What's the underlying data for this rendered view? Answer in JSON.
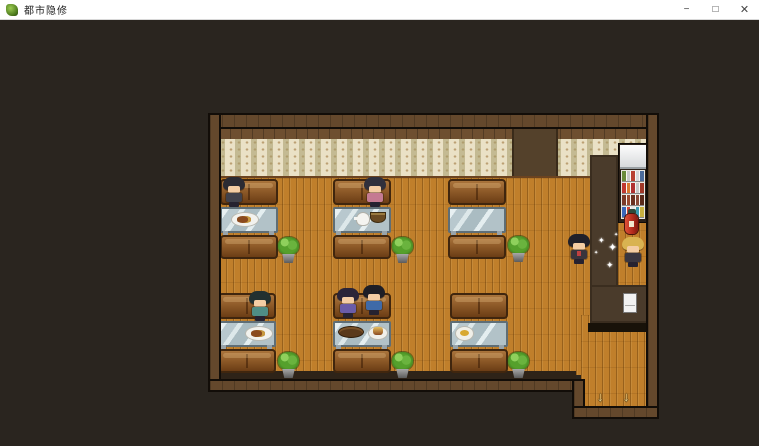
{
  "window": {
    "title": "都市隐修",
    "controls": {
      "minimize": "−",
      "maximize": "□",
      "close": "✕"
    }
  },
  "colors": {
    "titlebar": "#ffffff",
    "viewport_bg": "#2a251f",
    "frame_wood": "#64482c",
    "wallpaper": "#eae1c6",
    "floor_wood": "#c07f2b",
    "couch": "#8f5b29",
    "table_glass": "#c6d4d9",
    "plant_green": "#55a02c",
    "star_white": "#ffffff",
    "exit_arrow": "#e8cd8a"
  },
  "scene": {
    "star_glyph": "✦",
    "exit_arrow_glyph": "↓",
    "booths": [
      {
        "x": 10,
        "y": 64,
        "foods": [
          {
            "type": "plate-meat",
            "dx": 12
          }
        ]
      },
      {
        "x": 123,
        "y": 64,
        "foods": [
          {
            "type": "teapot",
            "dx": 24
          },
          {
            "type": "bowl",
            "dx": 38
          }
        ]
      },
      {
        "x": 238,
        "y": 64,
        "foods": []
      },
      {
        "x": 8,
        "y": 178,
        "foods": [
          {
            "type": "plate-meat",
            "dx": 28
          }
        ]
      },
      {
        "x": 123,
        "y": 178,
        "foods": [
          {
            "type": "fish",
            "dx": 6
          },
          {
            "type": "burger",
            "dx": 36
          }
        ]
      },
      {
        "x": 240,
        "y": 178,
        "foods": [
          {
            "type": "round-plate",
            "dx": 6
          }
        ]
      }
    ],
    "plants": [
      {
        "x": 68,
        "y": 122
      },
      {
        "x": 182,
        "y": 122
      },
      {
        "x": 298,
        "y": 121
      },
      {
        "x": 68,
        "y": 237
      },
      {
        "x": 182,
        "y": 237
      },
      {
        "x": 298,
        "y": 237
      }
    ],
    "characters": [
      {
        "x": 12,
        "y": 62,
        "z": 3,
        "hair": "#2b2b33",
        "shirt": "#41414b",
        "accent": ""
      },
      {
        "x": 153,
        "y": 62,
        "z": 3,
        "hair": "#30303c",
        "shirt": "#c57b92",
        "accent": ""
      },
      {
        "x": 38,
        "y": 176,
        "z": 3,
        "hair": "#223030",
        "shirt": "#4f8d85",
        "accent": ""
      },
      {
        "x": 126,
        "y": 173,
        "z": 3,
        "hair": "#2a2438",
        "shirt": "#6a5ca8",
        "accent": ""
      },
      {
        "x": 152,
        "y": 170,
        "z": 3,
        "hair": "#1e1e26",
        "shirt": "#3f6aa8",
        "accent": ""
      },
      {
        "x": 357,
        "y": 119,
        "z": 5,
        "hair": "#20202a",
        "shirt": "#39343c",
        "accent": "#c04040"
      },
      {
        "x": 411,
        "y": 122,
        "z": 5,
        "hair": "#d9b351",
        "shirt": "#3a3640",
        "accent": ""
      }
    ],
    "stars": [
      {
        "x": 388,
        "y": 122,
        "s": 8
      },
      {
        "x": 398,
        "y": 128,
        "s": 11
      },
      {
        "x": 384,
        "y": 136,
        "s": 5
      },
      {
        "x": 396,
        "y": 146,
        "s": 9
      },
      {
        "x": 404,
        "y": 118,
        "s": 5
      }
    ],
    "exit_arrows": [
      {
        "x": 387,
        "y": 274
      },
      {
        "x": 413,
        "y": 274
      }
    ],
    "vending_rows": [
      [
        "#6a8a3a",
        "#c8c8c8",
        "#b84030",
        "#d8d8d8",
        "#4a6a9a"
      ],
      [
        "#c03830",
        "#d87830",
        "#b03030",
        "#c8c8c8",
        "#a03828"
      ],
      [
        "#7a3a28",
        "#9a4a30",
        "#6a3020",
        "#8a4a38",
        "#5a2a1a"
      ],
      [
        "#3a66b8",
        "#d04438",
        "#e8e8e8",
        "#3a9ab0",
        "#c8b040"
      ]
    ]
  }
}
